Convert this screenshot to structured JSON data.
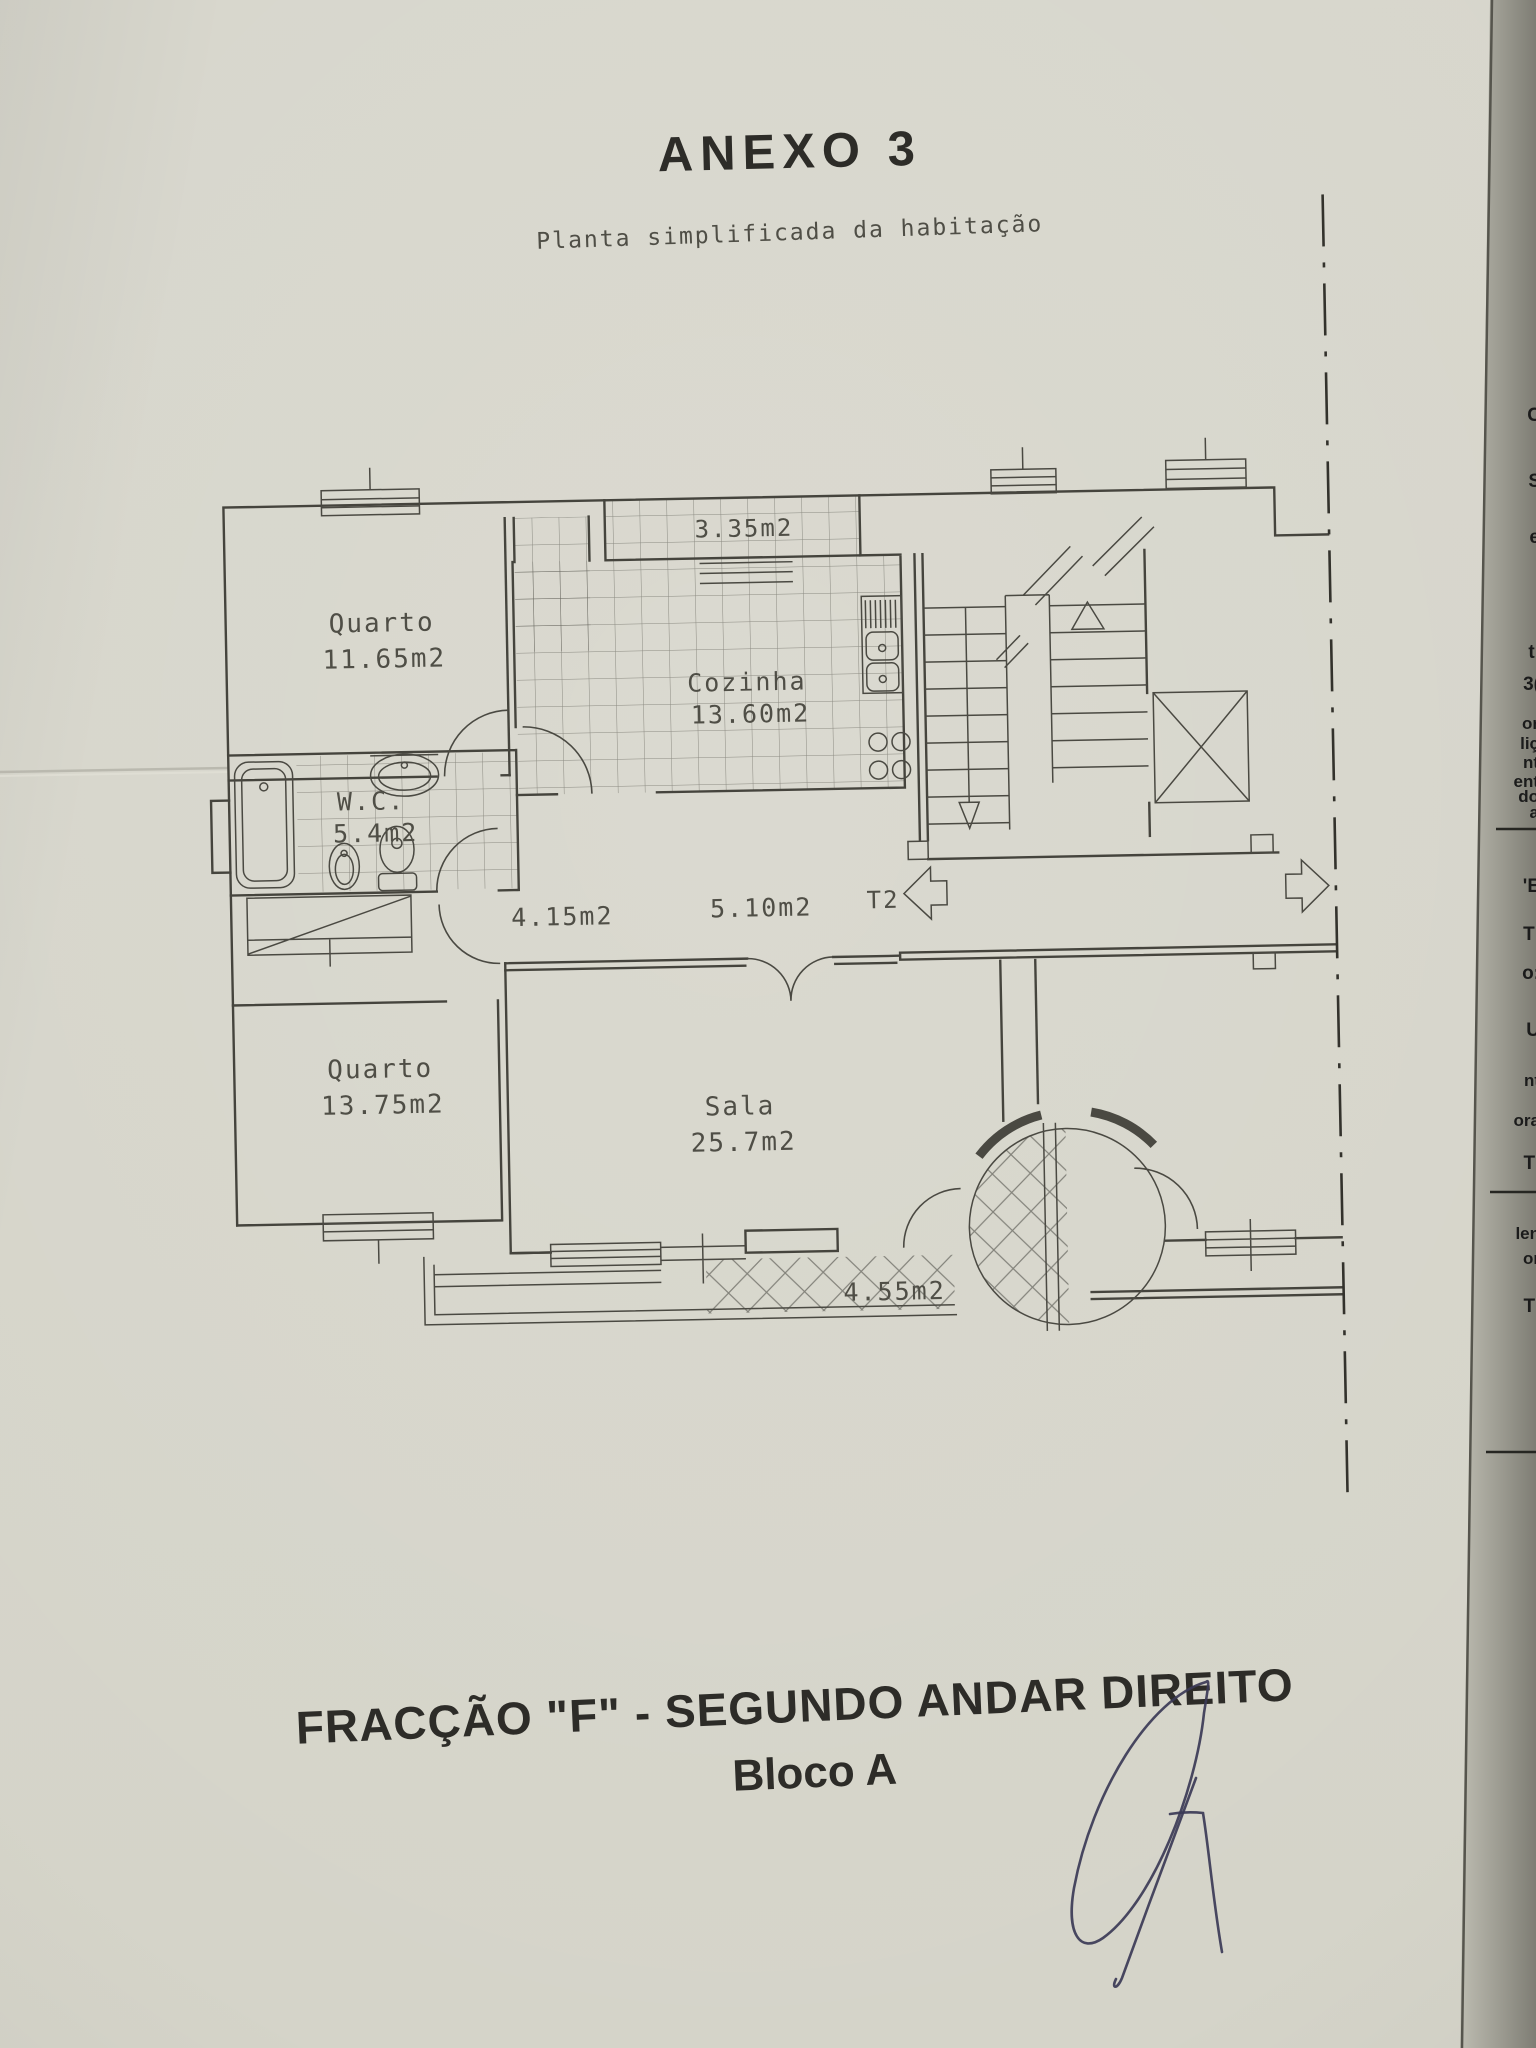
{
  "page": {
    "title": "ANEXO 3",
    "subtitle": "Planta simplificada da habitação"
  },
  "plan": {
    "labels": {
      "quarto1_name": "Quarto",
      "quarto1_area": "11.65m2",
      "balcao_top_area": "3.35m2",
      "cozinha_name": "Cozinha",
      "cozinha_area": "13.60m2",
      "wc_name": "W.C.",
      "wc_area": "5.4m2",
      "hall_area": "4.15m2",
      "corredor_area": "5.10m2",
      "typology": "T2",
      "quarto2_name": "Quarto",
      "quarto2_area": "13.75m2",
      "sala_name": "Sala",
      "sala_area": "25.7m2",
      "varanda_area": "4.55m2"
    }
  },
  "footer": {
    "line1_bold": "FRACÇÃO  \"F\"",
    "line1_rest": " - SEGUNDO ANDAR DIREITO",
    "line2": "Bloco A"
  },
  "edge_fragments": [
    "C",
    "S",
    "e",
    "I",
    "I",
    "ti",
    "3(",
    "or",
    "liç",
    "nt",
    "ent",
    "do",
    "a",
    "'E",
    "TI",
    "o:",
    "U",
    "nt",
    "ora",
    "Ti",
    "len",
    "or",
    "Ti"
  ],
  "colors": {
    "paper": "#d6d5cb",
    "ink": "#45443d",
    "title_ink": "#2d2c28",
    "signature_ink": "#3b3956",
    "underlay_page": "#9b9a90"
  }
}
